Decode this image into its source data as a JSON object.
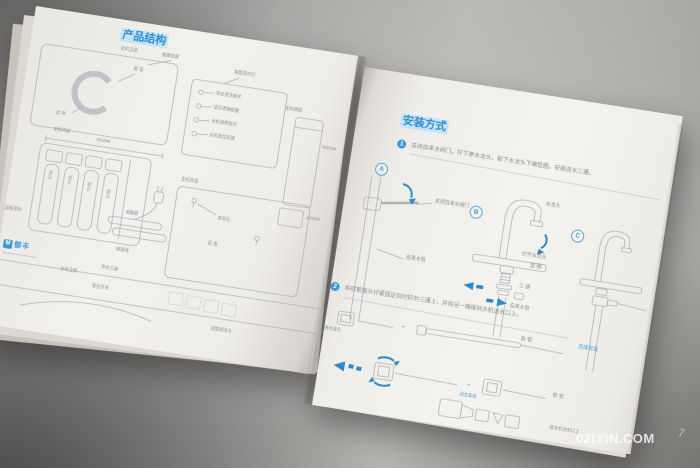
{
  "photo": {
    "watermark": "02IYIN.COM",
    "watermark_mark": "7"
  },
  "colors": {
    "accent": "#3e97d5",
    "line_art": "#aeb2b6",
    "highlight": "#c7e3f6"
  },
  "left_page": {
    "title": "产品结构",
    "front_label": "主机正面",
    "knob_label": "旋 钮",
    "outlet_label": "出 水",
    "touch_label": "触摸按键",
    "indicator_label": "智能指示灯",
    "indicator_items": [
      "净水清洗模式",
      "滤芯更换提醒",
      "水机保养提示",
      "水机复位按键"
    ],
    "inside_label": "主机内部",
    "dim_width": "460MM",
    "side_label": "主机侧面",
    "dim_height": "392MM",
    "dim_depth": "150MM",
    "filter_labels": [
      "滤芯",
      "滤芯",
      "滤芯",
      "滤芯"
    ],
    "board_label": "电脑板",
    "power_label": "电源线",
    "back_label": "主机背面",
    "hole_label": "安装孔",
    "cover_label": "后 盖",
    "section_label": "滤瓶部分",
    "tee_label": "净水三通",
    "note_label": "水机注意",
    "reset_label": "复位开关",
    "goose_label": "接鹅颈龙头",
    "brand_mark": "M",
    "brand_name": "御丰"
  },
  "right_page": {
    "title": "安装方式",
    "step1_num": "1",
    "step1_text": "关闭自来水阀门，拧下原水龙头，取下水龙头下端垫圈，安装进水三通。",
    "step2_num": "2",
    "step2_text": "将软管接头拧紧固定到拧好的三通上，并将另一端接到水机进水口上。",
    "badge_a": "A",
    "badge_b": "B",
    "badge_c": "C",
    "close_valve": "关闭自来水阀门",
    "tap_pipe_a": "自来水管",
    "faucet_label": "水龙头",
    "unscrew_label": "拧开水龙头",
    "washer_label": "垫 圈",
    "tee_label": "三 通",
    "tap_pipe_b": "自来水管",
    "done_label": "完成安装",
    "joint_label": "进水接头",
    "hose_label_1": "软 管",
    "plus": "+",
    "combine_label": "组合安装",
    "hose_label_2": "软 管",
    "inlet_label": "接水机进水口上"
  }
}
